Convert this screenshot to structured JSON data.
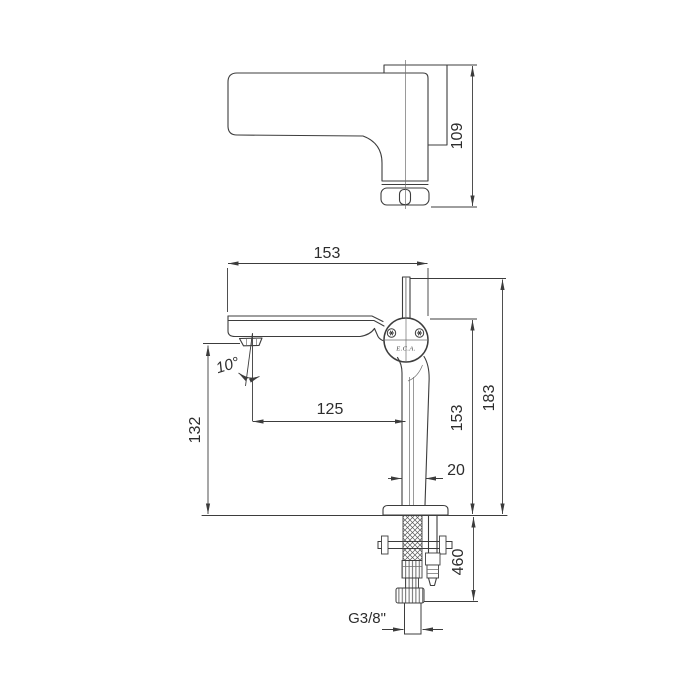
{
  "drawing": {
    "brand": "E.C.A.",
    "views": {
      "top": {
        "depth": "109"
      },
      "front": {
        "overall_width": "153",
        "overall_height": "183",
        "spout_top_height": "153",
        "outlet_height": "132",
        "outlet_reach": "125",
        "body_width": "20",
        "outlet_angle": "10°",
        "supply_hose_length": "460",
        "thread_size": "G3/8\""
      }
    }
  }
}
